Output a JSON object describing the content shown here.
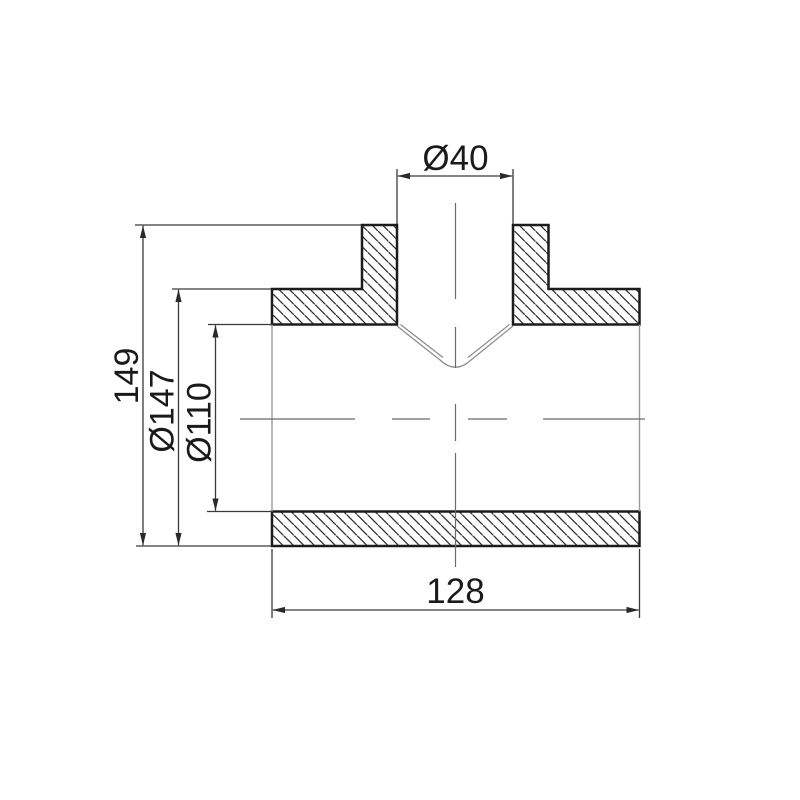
{
  "drawing": {
    "labels": {
      "branch_diameter": "Ø40",
      "height": "149",
      "outer_diameter": "Ø147",
      "bore_diameter": "Ø110",
      "length": "128"
    },
    "values": {
      "branch_diameter": 40,
      "height": 149,
      "outer_diameter": 147,
      "bore_diameter": 110,
      "length": 128
    },
    "colors": {
      "outline": "#1c1c1c",
      "dimension_lines": "#3a3a3a",
      "centerline": "#6b6b6b",
      "background": "#ffffff"
    }
  }
}
